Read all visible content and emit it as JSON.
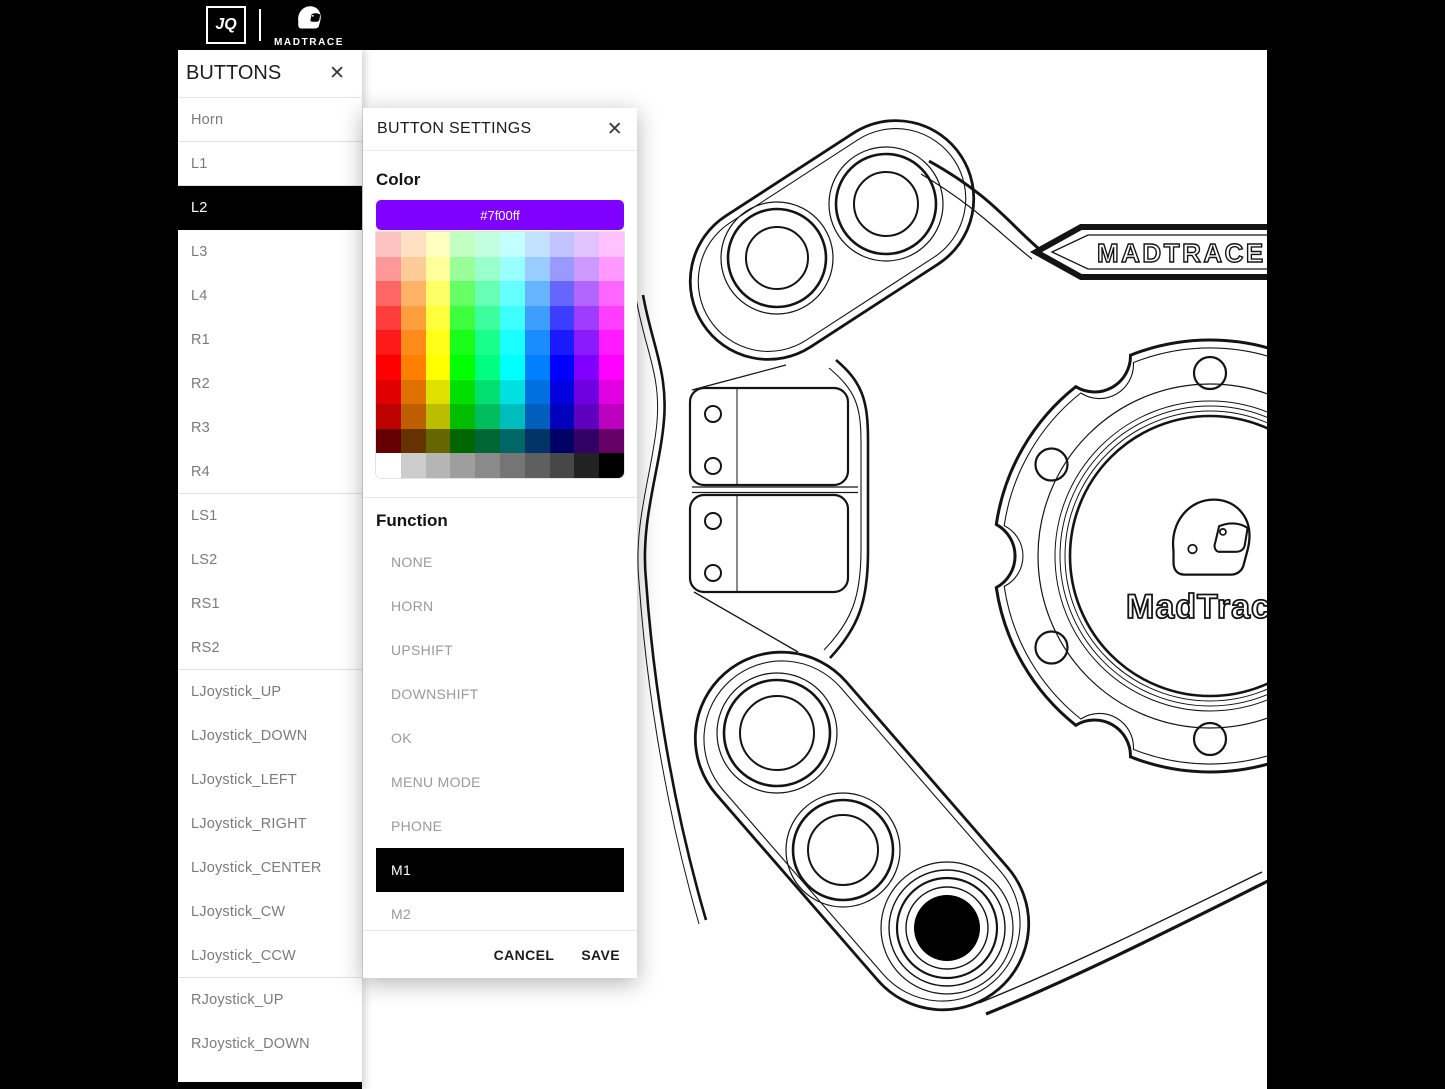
{
  "topbar": {
    "jq_logo": "JQ",
    "brand": "MADTRACE"
  },
  "sidebar": {
    "title": "BUTTONS",
    "close_icon": "✕",
    "items": [
      {
        "label": "Horn",
        "selected": false,
        "divider_after": true
      },
      {
        "label": "L1",
        "selected": false,
        "divider_after": true
      },
      {
        "label": "L2",
        "selected": true,
        "divider_after": false
      },
      {
        "label": "L3",
        "selected": false,
        "divider_after": false
      },
      {
        "label": "L4",
        "selected": false,
        "divider_after": false
      },
      {
        "label": "R1",
        "selected": false,
        "divider_after": false
      },
      {
        "label": "R2",
        "selected": false,
        "divider_after": false
      },
      {
        "label": "R3",
        "selected": false,
        "divider_after": false
      },
      {
        "label": "R4",
        "selected": false,
        "divider_after": true
      },
      {
        "label": "LS1",
        "selected": false,
        "divider_after": false
      },
      {
        "label": "LS2",
        "selected": false,
        "divider_after": false
      },
      {
        "label": "RS1",
        "selected": false,
        "divider_after": false
      },
      {
        "label": "RS2",
        "selected": false,
        "divider_after": true
      },
      {
        "label": "LJoystick_UP",
        "selected": false,
        "divider_after": false
      },
      {
        "label": "LJoystick_DOWN",
        "selected": false,
        "divider_after": false
      },
      {
        "label": "LJoystick_LEFT",
        "selected": false,
        "divider_after": false
      },
      {
        "label": "LJoystick_RIGHT",
        "selected": false,
        "divider_after": false
      },
      {
        "label": "LJoystick_CENTER",
        "selected": false,
        "divider_after": false
      },
      {
        "label": "LJoystick_CW",
        "selected": false,
        "divider_after": false
      },
      {
        "label": "LJoystick_CCW",
        "selected": false,
        "divider_after": true
      },
      {
        "label": "RJoystick_UP",
        "selected": false,
        "divider_after": false
      },
      {
        "label": "RJoystick_DOWN",
        "selected": false,
        "divider_after": false
      }
    ]
  },
  "modal": {
    "title": "BUTTON SETTINGS",
    "close_icon": "✕",
    "color_label": "Color",
    "selected_color_hex": "#7f00ff",
    "palette": {
      "hues": [
        0,
        30,
        60,
        120,
        150,
        180,
        210,
        240,
        270,
        300
      ],
      "lightness_rows": [
        88,
        80,
        70,
        62,
        55,
        50,
        44,
        37,
        20
      ],
      "grayscale_row": [
        "#ffffff",
        "#cccccc",
        "#b5b5b5",
        "#9e9e9e",
        "#8a8a8a",
        "#757575",
        "#5f5f5f",
        "#474747",
        "#222222",
        "#000000"
      ]
    },
    "function_label": "Function",
    "function_options": [
      {
        "label": "NONE",
        "selected": false
      },
      {
        "label": "HORN",
        "selected": false
      },
      {
        "label": "UPSHIFT",
        "selected": false
      },
      {
        "label": "DOWNSHIFT",
        "selected": false
      },
      {
        "label": "OK",
        "selected": false
      },
      {
        "label": "MENU MODE",
        "selected": false
      },
      {
        "label": "PHONE",
        "selected": false
      },
      {
        "label": "M1",
        "selected": true
      },
      {
        "label": "M2",
        "selected": false
      }
    ],
    "cancel_label": "CANCEL",
    "save_label": "SAVE"
  },
  "drawing": {
    "stalk_brand_text": "MADTRACE",
    "hub_brand_text": "MadTrace",
    "line_color": "#141414",
    "button_fill_black": "#000000"
  }
}
